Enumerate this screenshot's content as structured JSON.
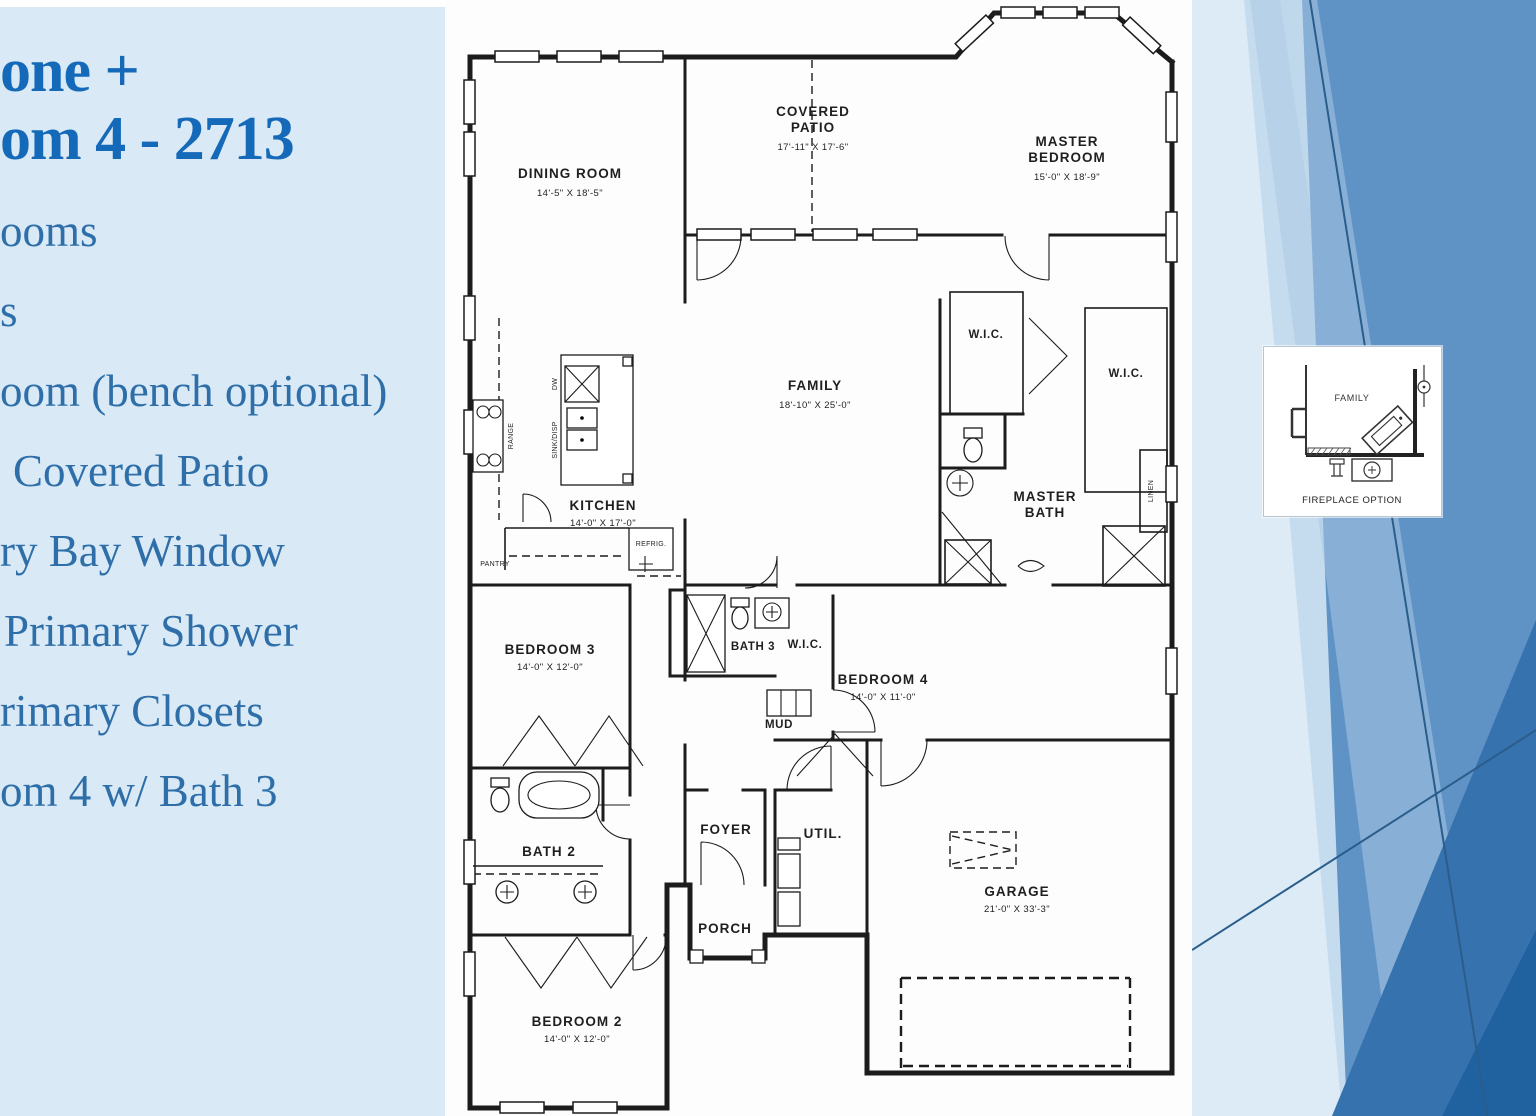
{
  "slide": {
    "title": {
      "line1": "one +",
      "line2": "om 4 - 2713"
    },
    "bullets": [
      {
        "label": "ooms"
      },
      {
        "label": "s"
      },
      {
        "label": "oom (bench optional)"
      },
      {
        "label": "Covered Patio"
      },
      {
        "label": "ry Bay Window"
      },
      {
        "label": "Primary Shower"
      },
      {
        "label": "rimary Closets"
      },
      {
        "label": "om 4 w/ Bath 3"
      }
    ]
  },
  "plan": {
    "rooms": {
      "dining": {
        "name": "DINING ROOM",
        "dims": "14'-5\" X 18'-5\""
      },
      "patio": {
        "name1": "COVERED",
        "name2": "PATIO",
        "dims": "17'-11\" X 17'-6\""
      },
      "master": {
        "name1": "MASTER",
        "name2": "BEDROOM",
        "dims": "15'-0\" X 18'-9\""
      },
      "wic_master_left": {
        "name": "W.I.C."
      },
      "wic_master_right": {
        "name": "W.I.C."
      },
      "master_bath": {
        "name1": "MASTER",
        "name2": "BATH"
      },
      "family": {
        "name": "FAMILY",
        "dims": "18'-10\" X 25'-0\""
      },
      "kitchen": {
        "name": "KITCHEN",
        "dims": "14'-0\" X 17'-0\""
      },
      "bedroom3": {
        "name": "BEDROOM 3",
        "dims": "14'-0\" X 12'-0\""
      },
      "bath3": {
        "name": "BATH 3"
      },
      "wic_bed4": {
        "name": "W.I.C."
      },
      "mud": {
        "name": "MUD"
      },
      "bedroom4": {
        "name": "BEDROOM 4",
        "dims": "14'-0\" X 11'-0\""
      },
      "bath2": {
        "name": "BATH 2"
      },
      "foyer": {
        "name": "FOYER"
      },
      "util": {
        "name": "UTIL."
      },
      "porch": {
        "name": "PORCH"
      },
      "bedroom2": {
        "name": "BEDROOM 2",
        "dims": "14'-0\" X 12'-0\""
      },
      "garage": {
        "name": "GARAGE",
        "dims": "21'-0\" X 33'-3\""
      }
    },
    "fixtures": {
      "range": "RANGE",
      "dw": "DW",
      "sink_disp": "SINK/DISP",
      "refrig": "REFRIG.",
      "pantry": "PANTRY",
      "linen": "LINEN"
    },
    "inset": {
      "room": "FAMILY",
      "caption": "FIREPLACE OPTION"
    }
  },
  "colors": {
    "title_blue": "#1569b9",
    "bullet_blue": "#2e6ea9",
    "panel_bg": "#d9e9f5",
    "wall_ink": "#1c1c1c",
    "bg_mid_blue": "#5f93c6",
    "bg_dark_blue": "#3572ae",
    "bg_deep_blue": "#20619f"
  }
}
